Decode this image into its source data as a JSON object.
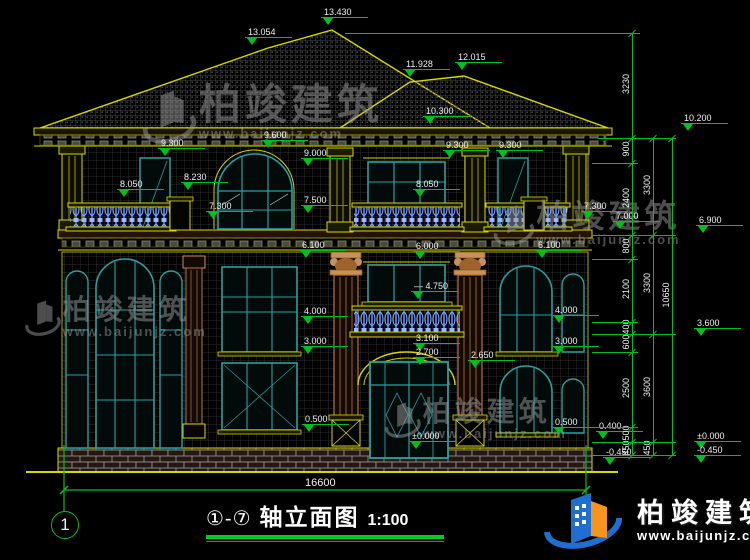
{
  "title_block": {
    "axis_range": "①-⑦",
    "name": "轴立面图",
    "scale": "1:100",
    "left_axis_bubble": "1",
    "total_dim": "16600"
  },
  "brand": {
    "name": "柏竣建筑",
    "url": "www.baijunjz.com"
  },
  "colors": {
    "background": "#000000",
    "cad_yellow": "#d8d800",
    "cad_green": "#00c020",
    "text_white": "#efefef",
    "window_teal": "#2aa0a0",
    "baluster_blue": "#5b8dff",
    "column_tan": "#b5763a",
    "brand_blue": "#1e6fd0",
    "brand_orange": "#f7941d"
  },
  "elevations": [
    {
      "v": "13.054",
      "x": 252,
      "y": 52
    },
    {
      "v": "13.430",
      "x": 328,
      "y": 32
    },
    {
      "v": "11.928",
      "x": 410,
      "y": 84
    },
    {
      "v": "12.015",
      "x": 462,
      "y": 77
    },
    {
      "v": "10.300",
      "x": 430,
      "y": 131
    },
    {
      "v": "10.200",
      "x": 688,
      "y": 138
    },
    {
      "v": "9.300",
      "x": 165,
      "y": 163
    },
    {
      "v": "9.600",
      "x": 268,
      "y": 155
    },
    {
      "v": "9.000",
      "x": 308,
      "y": 173
    },
    {
      "v": "9.300",
      "x": 450,
      "y": 165
    },
    {
      "v": "9.300",
      "x": 503,
      "y": 165
    },
    {
      "v": "8.050",
      "x": 124,
      "y": 204
    },
    {
      "v": "8.230",
      "x": 188,
      "y": 197
    },
    {
      "v": "7.300",
      "x": 213,
      "y": 226
    },
    {
      "v": "7.500",
      "x": 308,
      "y": 220
    },
    {
      "v": "8.050",
      "x": 420,
      "y": 204
    },
    {
      "v": "7.300",
      "x": 588,
      "y": 226
    },
    {
      "v": "7.000",
      "x": 620,
      "y": 236
    },
    {
      "v": "6.900",
      "x": 703,
      "y": 240
    },
    {
      "v": "6.100",
      "x": 306,
      "y": 265
    },
    {
      "v": "6.000",
      "x": 420,
      "y": 266
    },
    {
      "v": "6.100",
      "x": 542,
      "y": 265
    },
    {
      "v": "4.750",
      "x": 418,
      "y": 306,
      "dash": true
    },
    {
      "v": "4.000",
      "x": 308,
      "y": 331
    },
    {
      "v": "3.000",
      "x": 308,
      "y": 361
    },
    {
      "v": "3.100",
      "x": 420,
      "y": 358
    },
    {
      "v": "2.700",
      "x": 420,
      "y": 372
    },
    {
      "v": "2.650",
      "x": 475,
      "y": 375
    },
    {
      "v": "4.000",
      "x": 559,
      "y": 330
    },
    {
      "v": "3.000",
      "x": 559,
      "y": 361
    },
    {
      "v": "0.500",
      "x": 309,
      "y": 439
    },
    {
      "v": "0.500",
      "x": 559,
      "y": 442
    },
    {
      "v": "0.400",
      "x": 603,
      "y": 446
    },
    {
      "v": "±0.000",
      "x": 416,
      "y": 456
    },
    {
      "v": "-0.450",
      "x": 610,
      "y": 472
    },
    {
      "v": "3.600",
      "x": 701,
      "y": 343
    },
    {
      "v": "±0.000",
      "x": 701,
      "y": 456
    },
    {
      "v": "-0.450",
      "x": 701,
      "y": 470
    }
  ],
  "chains": [
    {
      "x": 632,
      "y1": 33,
      "y2": 455,
      "ticks": [
        33,
        138,
        163,
        235,
        259,
        322,
        334,
        352,
        427,
        442,
        455
      ],
      "labels": [
        {
          "t": "3230",
          "y": 85
        },
        {
          "t": "900",
          "y": 150
        },
        {
          "t": "2400",
          "y": 199
        },
        {
          "t": "800",
          "y": 247
        },
        {
          "t": "2100",
          "y": 290
        },
        {
          "t": "400",
          "y": 328
        },
        {
          "t": "600",
          "y": 343
        },
        {
          "t": "2500",
          "y": 389
        },
        {
          "t": "500",
          "y": 434
        },
        {
          "t": "450",
          "y": 449
        }
      ]
    },
    {
      "x": 653,
      "y1": 138,
      "y2": 455,
      "ticks": [
        138,
        235,
        334,
        442,
        455
      ],
      "labels": [
        {
          "t": "3300",
          "y": 186
        },
        {
          "t": "3300",
          "y": 284
        },
        {
          "t": "3600",
          "y": 388
        },
        {
          "t": "450",
          "y": 449
        }
      ]
    },
    {
      "x": 672,
      "y1": 138,
      "y2": 455,
      "ticks": [
        138,
        455
      ],
      "labels": [
        {
          "t": "10650",
          "y": 296
        }
      ]
    }
  ],
  "levels": [
    {
      "y": 33,
      "x1": 345,
      "x2": 640
    },
    {
      "y": 138,
      "x1": 598,
      "x2": 676
    },
    {
      "y": 163,
      "x1": 592,
      "x2": 638
    },
    {
      "y": 235,
      "x1": 592,
      "x2": 676
    },
    {
      "y": 259,
      "x1": 592,
      "x2": 638
    },
    {
      "y": 322,
      "x1": 592,
      "x2": 638
    },
    {
      "y": 334,
      "x1": 592,
      "x2": 676
    },
    {
      "y": 352,
      "x1": 592,
      "x2": 638
    },
    {
      "y": 427,
      "x1": 592,
      "x2": 638
    },
    {
      "y": 442,
      "x1": 592,
      "x2": 676
    },
    {
      "y": 455,
      "x1": 592,
      "x2": 676
    }
  ],
  "watermarks": [
    {
      "text": "柏竣建筑",
      "url": "www.baijunjz.com",
      "x": 138,
      "y": 84,
      "size": 42,
      "logo": true
    },
    {
      "text": "柏竣建筑",
      "url": "www.baijunjz.com",
      "x": 490,
      "y": 200,
      "size": 32,
      "logo": true
    },
    {
      "text": "柏竣建筑",
      "url": "www.baijunjz.com",
      "x": 22,
      "y": 296,
      "size": 28,
      "logo": true
    },
    {
      "text": "柏竣建筑",
      "url": "www.baijunjz.com",
      "x": 382,
      "y": 398,
      "size": 28,
      "logo": true
    }
  ]
}
